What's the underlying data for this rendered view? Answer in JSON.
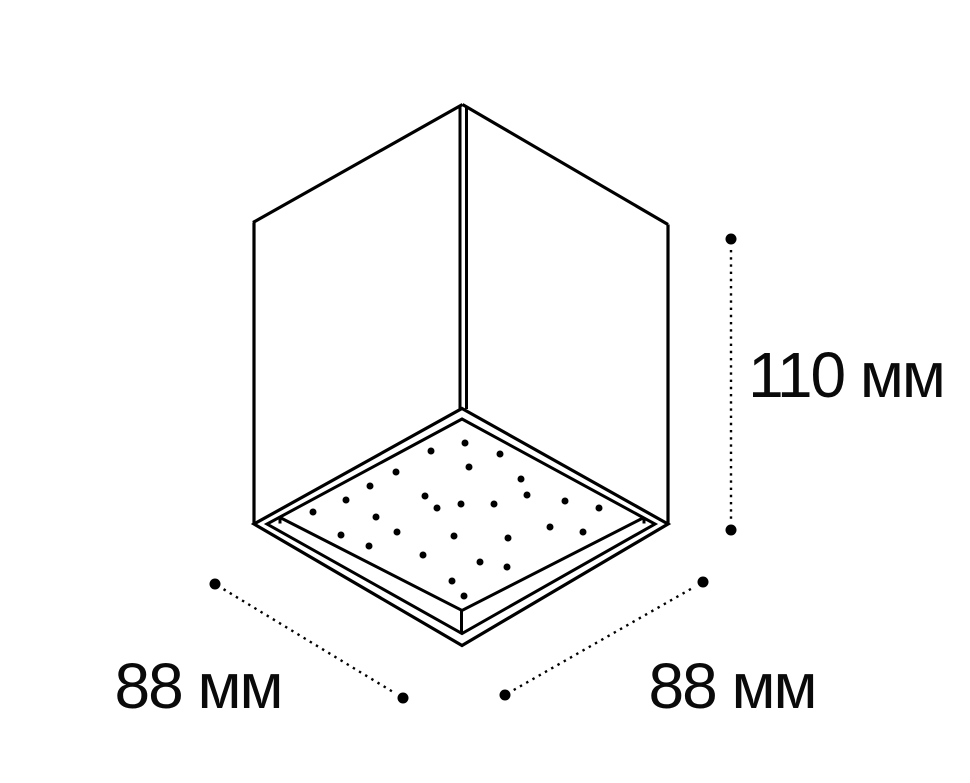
{
  "figure": {
    "description_labels": {
      "height_dimension": "110 мм",
      "base_left_dimension": "88 мм",
      "base_right_dimension": "88 мм"
    },
    "dimensions": [
      {
        "id": "height",
        "label": "110 мм",
        "value": 110,
        "unit": "мм"
      },
      {
        "id": "base-left",
        "label": "88 мм",
        "value": 88,
        "unit": "мм"
      },
      {
        "id": "base-right",
        "label": "88 мм",
        "value": 88,
        "unit": "мм"
      }
    ],
    "colors": {
      "background": "#ffffff",
      "line": "#000000",
      "text": "#0a0a0a"
    },
    "led_dots": [
      [
        465,
        443
      ],
      [
        431,
        451
      ],
      [
        500,
        454
      ],
      [
        469,
        467
      ],
      [
        396,
        472
      ],
      [
        521,
        479
      ],
      [
        370,
        486
      ],
      [
        425,
        496
      ],
      [
        527,
        495
      ],
      [
        346,
        500
      ],
      [
        461,
        504
      ],
      [
        494,
        504
      ],
      [
        565,
        501
      ],
      [
        437,
        508
      ],
      [
        599,
        508
      ],
      [
        313,
        512
      ],
      [
        376,
        517
      ],
      [
        550,
        527
      ],
      [
        583,
        532
      ],
      [
        341,
        535
      ],
      [
        397,
        532
      ],
      [
        454,
        536
      ],
      [
        508,
        538
      ],
      [
        369,
        546
      ],
      [
        423,
        555
      ],
      [
        480,
        562
      ],
      [
        507,
        567
      ],
      [
        452,
        581
      ],
      [
        464,
        596
      ]
    ],
    "led_dot_radius": 3.5
  }
}
